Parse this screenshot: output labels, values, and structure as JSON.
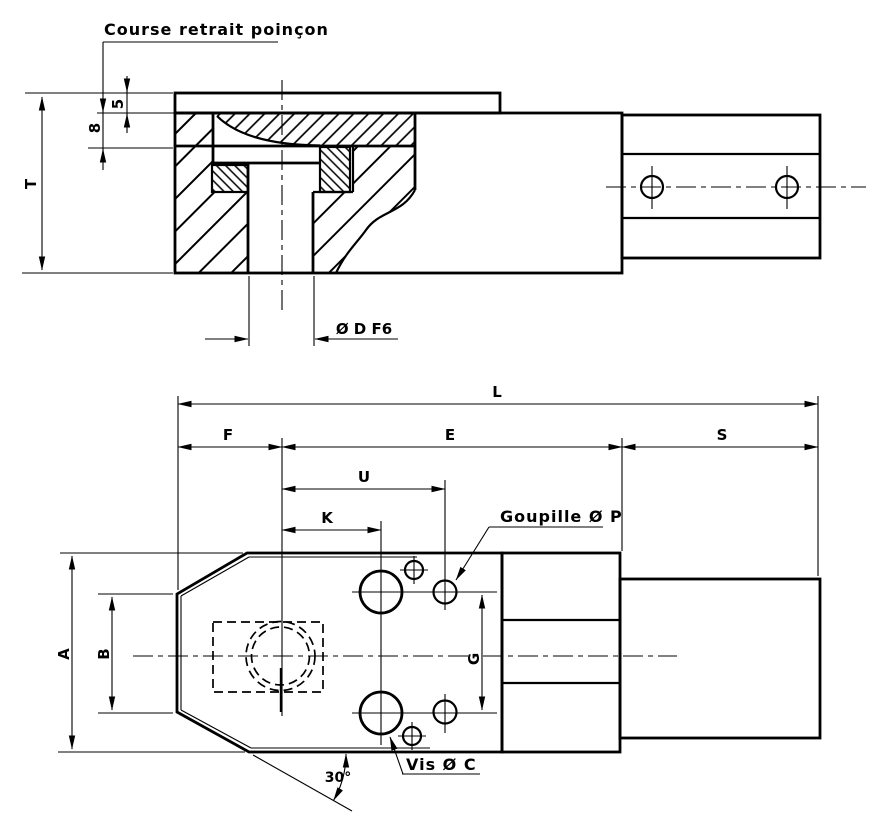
{
  "drawing": {
    "title_note": "Course retrait poinçon",
    "background": "#ffffff",
    "line_color": "#000000",
    "views": {
      "front_section": "sectioned front view of punch retainer",
      "plan": "plan view of punch retainer"
    },
    "labels": {
      "course_retrait": "Course retrait poinçon",
      "dim_5": "5",
      "dim_8": "8",
      "dim_T": "T",
      "dia_D": "Ø D F6",
      "dim_L": "L",
      "dim_F": "F",
      "dim_E": "E",
      "dim_S": "S",
      "dim_U": "U",
      "dim_K": "K",
      "goupille": "Goupille Ø P",
      "dim_G": "G",
      "dim_A": "A",
      "dim_B": "B",
      "vis": "Vis Ø C",
      "angle_30": "30°"
    }
  }
}
